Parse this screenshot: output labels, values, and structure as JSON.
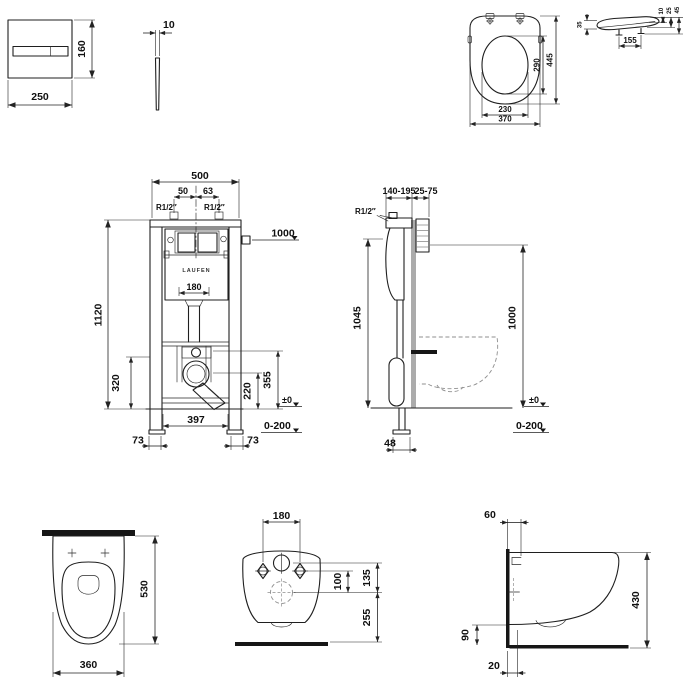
{
  "views": {
    "flush_plate_front": {
      "width": "250",
      "height": "160"
    },
    "flush_plate_side": {
      "thickness": "10"
    },
    "seat_top": {
      "overall_width": "370",
      "ring_width": "230",
      "ring_length": "290",
      "overall_length": "445"
    },
    "seat_side": {
      "hinge_spacing": "155",
      "rear_height": "35",
      "h_top": "10",
      "h_mid": "25",
      "h_total": "45"
    },
    "frame_front": {
      "width": "500",
      "offset_left": "50",
      "offset_right": "63",
      "conn_left": "R1/2″",
      "conn_right": "R1/2″",
      "supply_height": "1000",
      "height": "1120",
      "bend_width": "180",
      "brand": "LAUFEN",
      "trap_center": "320",
      "outlet_center": "220",
      "fixing_height": "355",
      "floor_level": "±0",
      "floor_range": "0-200",
      "leg_span": "397",
      "foot_left": "73",
      "foot_right": "73"
    },
    "frame_side": {
      "depth": "140-195",
      "wall_finish": "25-75",
      "conn": "R1/2″",
      "height": "1045",
      "supply_height": "1000",
      "floor_level": "±0",
      "floor_range": "0-200",
      "foot_depth": "48"
    },
    "wc_top": {
      "length": "530",
      "width": "360"
    },
    "wc_rear": {
      "hole_spacing": "180",
      "outlet_offset": "100",
      "inlet_offset": "135",
      "outlet_height": "255"
    },
    "wc_side": {
      "top_fixing": "60",
      "height": "430",
      "bottom_height": "90",
      "wall_offset": "20"
    }
  },
  "colors": {
    "line": "#1f1f1f",
    "wall_section": "#ababab",
    "hidden_line": "#8f8f8f",
    "solid_fill": "#161616",
    "background": "#ffffff"
  }
}
